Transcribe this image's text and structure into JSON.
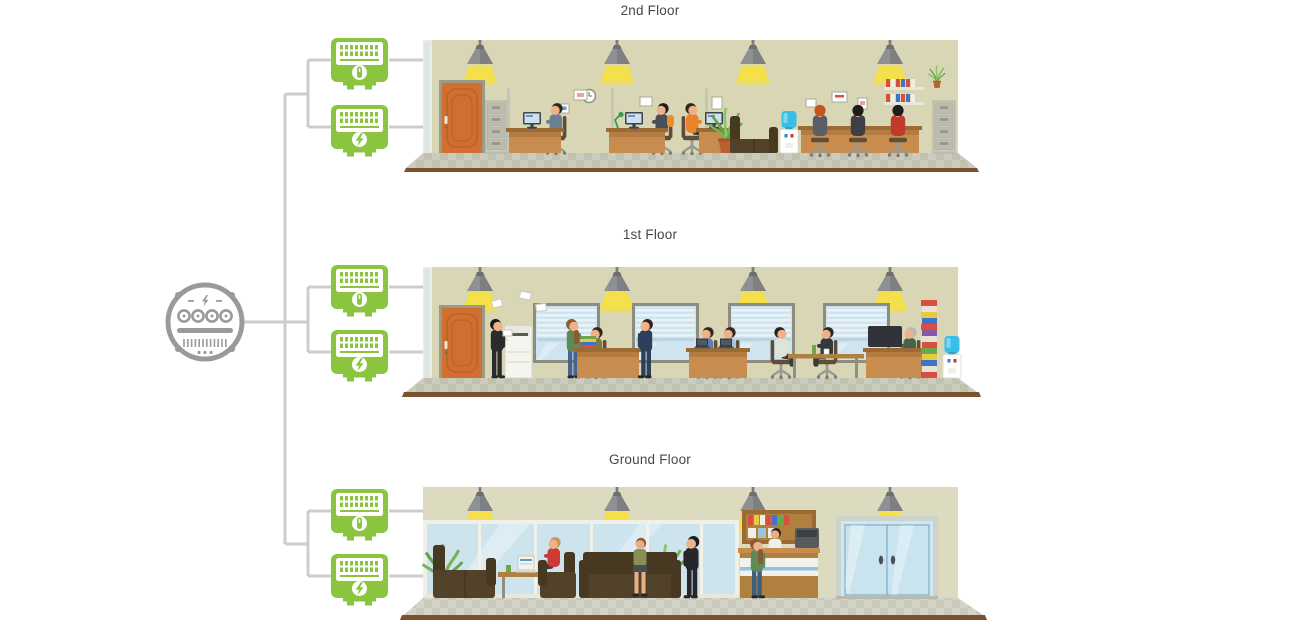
{
  "floors": [
    {
      "id": "second",
      "label": "2nd Floor",
      "submeters": [
        "plug-submeter",
        "bolt-submeter"
      ]
    },
    {
      "id": "first",
      "label": "1st Floor",
      "submeters": [
        "plug-submeter",
        "bolt-submeter"
      ]
    },
    {
      "id": "ground",
      "label": "Ground Floor",
      "submeters": [
        "plug-submeter",
        "bolt-submeter"
      ]
    }
  ],
  "main_meter": {
    "icon": "utility-meter-icon",
    "color": "#9a9a9a",
    "features": [
      "lightning-bolt",
      "four-dials",
      "display-slot",
      "barcode"
    ]
  },
  "submeter": {
    "color": "#8bc53f",
    "icon_variants": [
      "plug-icon",
      "lightning-bolt-icon"
    ],
    "screen": "digital-readout",
    "count_total": 6
  },
  "connectors": {
    "color": "#cdcdcd",
    "style": "orthogonal-tree"
  },
  "palette": {
    "wall": "#d8d6b5",
    "wall_ground": "#dcdabf",
    "tile_light": "#ccccbe",
    "tile_dark": "#c1c1b1",
    "floor_edge": "#7b512f",
    "lamp_shade": "#909296",
    "lamp_light": "#f6e045",
    "door": "#cf7030",
    "desk_front": "#c88c4f",
    "desk_top": "#9c6a33",
    "couch": "#53422a",
    "couch_dark": "#473821",
    "window_glass": "#cfe4ee",
    "window_frame": "#8d8d7f",
    "water_bottle": "#38bfe8",
    "label_text": "#474747"
  },
  "scenes": {
    "second_floor": [
      "pendant-lamps",
      "office-door",
      "filing-cabinets",
      "cubicle-desks",
      "office-workers",
      "wall-clock",
      "couch",
      "water-cooler",
      "plant",
      "binder-shelf"
    ],
    "first_floor": [
      "pendant-lamps",
      "office-door",
      "copier",
      "windows-with-blinds",
      "reception-desks",
      "standing-visitors",
      "office-workers",
      "meeting-table",
      "binder-stack",
      "water-cooler"
    ],
    "ground_floor": [
      "pendant-lamps",
      "glass-wall",
      "lobby-sofas",
      "coffee-table",
      "laptop",
      "visitors",
      "plants",
      "reception-desk",
      "receptionist",
      "glass-entrance-doors"
    ]
  }
}
